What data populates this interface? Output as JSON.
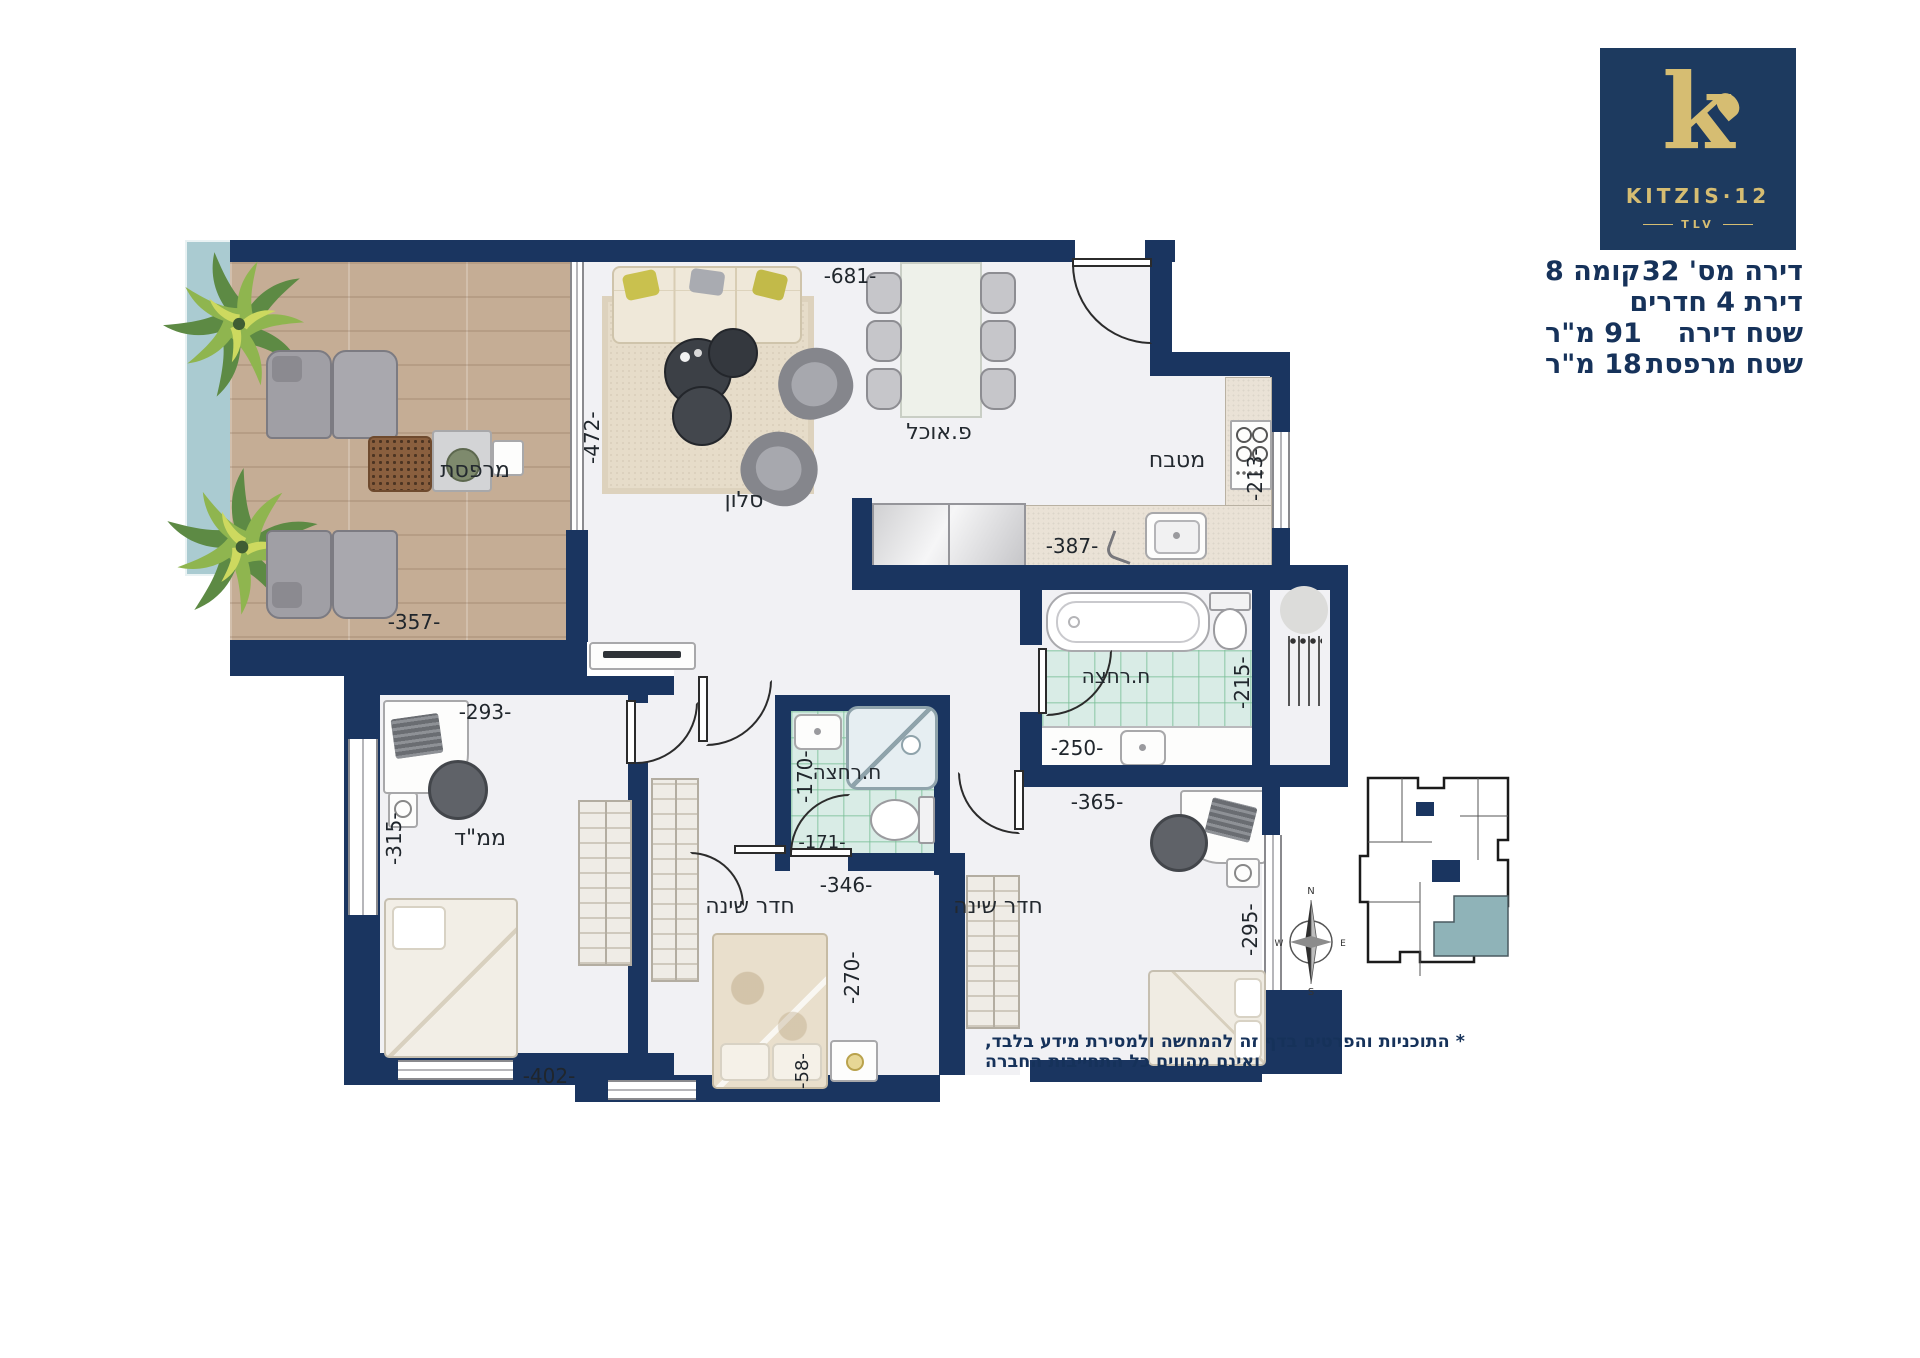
{
  "logo": {
    "letter": "k",
    "brand": "KITZIS·12",
    "city": "TLV"
  },
  "info": {
    "rows": [
      {
        "right": "דירה מס' 32",
        "left": "קומה 8"
      },
      {
        "right": "דירת 4 חדרים",
        "left": ""
      },
      {
        "right": "שטח דירה",
        "left": "91 מ\"ר"
      },
      {
        "right": "שטח מרפסת",
        "left": "18 מ\"ר"
      }
    ]
  },
  "rooms": {
    "balcony": "מרפסת",
    "living": "סלון",
    "dining": "פ.אוכל",
    "kitchen": "מטבח",
    "bath_main": "ח.רחצה",
    "bath_shower": "ח.רחצה",
    "safe_room": "ממ\"ד",
    "bedroom_middle": "חדר שינה",
    "bedroom_right": "חדר שינה"
  },
  "dimensions": {
    "top": "-681-",
    "living_left": "-472-",
    "balcony_bottom": "-357-",
    "safe_room_top": "-293-",
    "safe_room_left": "-315-",
    "kitchen_counter": "-387-",
    "kitchen_right": "-213-",
    "bath_right": "-215-",
    "bath_bottom": "-250-",
    "bedroom_right_top": "-365-",
    "shower_left": "-170-",
    "shower_bottom": "-171-",
    "bedroom_mid_top": "-346-",
    "bedroom_mid_right": "-270-",
    "bedroom_right_side": "-295-",
    "bottom_left": "-402-",
    "bottom_mid": "-58-"
  },
  "compass": {
    "n": "N",
    "e": "E",
    "s": "S",
    "w": "W"
  },
  "disclaimer": "* התוכניות והפרטים בדף זה להמחשה ולמסירת מידע בלבד, ואינם מהווים כל התחייבות החברה"
}
